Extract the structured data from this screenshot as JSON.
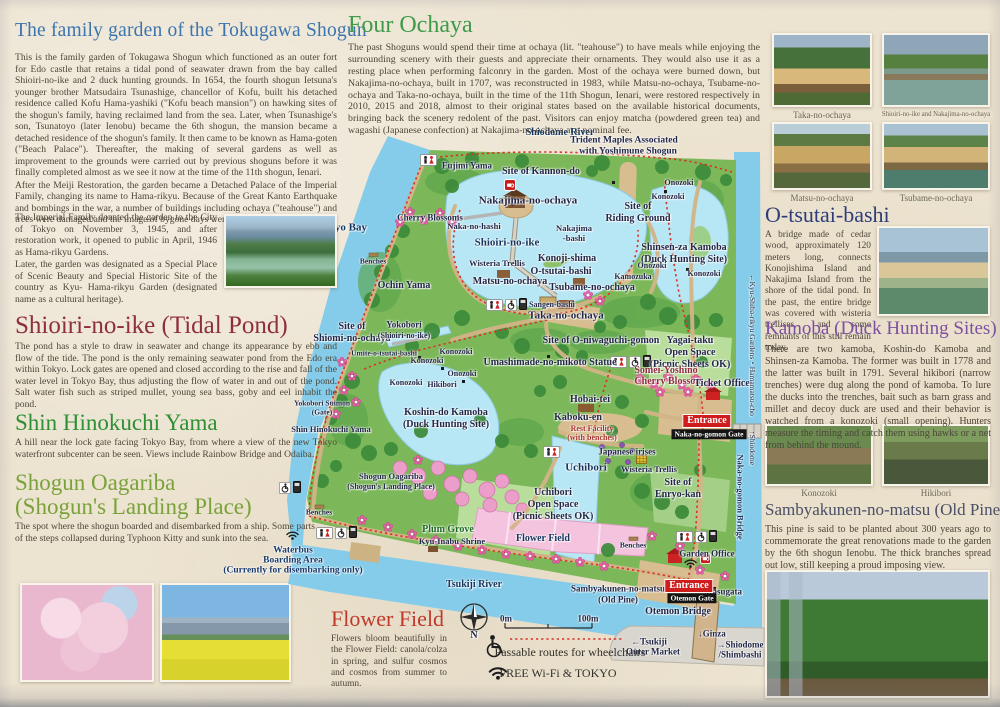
{
  "left": {
    "title": "The family garden of the Tokugawa Shogun",
    "p1": "This is the family garden of Tokugawa Shogun which functioned as an outer fort for Edo castle that retains a tidal pond of seawater drawn from the bay called Shioiri-no-ike and 2 duck hunting grounds. In 1654, the fourth shogun Ietsuna's younger brother Matsudaira Tsunashige, chancellor of Kofu, built his detached residence called Kofu Hama-yashiki (\"Kofu beach mansion\") on hawking sites of the shogun's family, having reclaimed land from the sea. Later, when Tsunashige's son, Tsunatoyo (later Ienobu) became the 6th shogun, the mansion became a detached residence of the shogun's family. It then came to be known as Hama-goten (\"Beach Palace\"). Thereafter, the making of several gardens as well as improvement to the grounds were carried out by previous shoguns before it was finally completed almost as we see it now at the time of the 11th shogun, Ienari.",
    "p2": "After the Meiji Restoration, the garden became a Detached Palace of the Imperial Family, changing its name to Hama-rikyu. Because of the Great Kanto Earthquake and bombings in the war, a number of buildings including ochaya (\"teahouse\") and trees were damaged and the image of bygone days were lost.",
    "p3": "The Imperial Family donated the garden to the City of Tokyo on November 3, 1945, and after restoration work, it opened to public in April, 1946 as Hama-rikyu Gardens.",
    "p4": "Later, the garden was designated as a Special Place of Scenic Beauty and Special Historic Site of the country as Kyu- Hama-rikyu Garden (designated name as a cultural heritage).",
    "shioiri_h": "Shioiri-no-ike (Tidal Pond)",
    "shioiri_p": "The pond has a style to draw in seawater and change its appearance by ebb and flow of the tide. The pond is the only remaining seawater pond from the Edo era within Tokyo. Lock gates are opened and closed according to the rise and fall of the water level in Tokyo Bay, thus adjusting the flow of water in and out of the pond. Salt water fish such as striped mullet, young sea bass, goby and eel inhabit the pond.",
    "shin_h": "Shin Hinokuchi Yama",
    "shin_p": "A hill near the lock gate facing Tokyo Bay, from where a view of the new Tokyo waterfront subcenter can be seen. Views include Rainbow Bridge and Odaiba.",
    "shogun_h1": "Shogun Oagariba",
    "shogun_h2": "(Shogun's Landing Place)",
    "shogun_p": "The spot where the shogun boarded and disembarked from a ship. Some parts of the steps collapsed during Typhoon Kitty and sunk into the sea."
  },
  "center": {
    "ochaya_h": "Four Ochaya",
    "ochaya_p": "The past Shoguns would spend their time at ochaya (lit. \"teahouse\") to have meals while enjoying the surrounding scenery with their guests and appreciate their ornaments. They would also use it as a resting place when performing falconry in the garden. Most of the ochaya were burned down, but Nakajima-no-ochaya, built in 1707, was reconstructed in 1983, while Matsu-no-ochaya, Tsubame-no-ochaya and Taka-no-ochaya, built in the time of the 11th Shogun, Ienari, were restored respectively in 2010, 2015 and 2018, almost to their original states based on the available historical documents, bringing back the scenery redolent of the past. Visitors can enjoy matcha (powdered green tea) and wagashi (Japanese confection) at Nakajima-no-ochaya at a nominal fee.",
    "flower_h": "Flower Field",
    "flower_p": "Flowers bloom beautifully in the Flower Field: canola/colza in spring, and sulfur cosmos and cosmos from summer to autumn."
  },
  "right": {
    "cap_taka": "Taka-no-ochaya",
    "cap_naka": "Shioiri-no-ike and Nakajima-no-ochaya",
    "cap_matsu": "Matsu-no-ochaya",
    "cap_tsubame": "Tsubame-no-ochaya",
    "otsutai_h": "O-tsutai-bashi",
    "otsutai_p": "A bridge made of cedar wood, approximately 120 meters long, connects Konojishima Island and Nakajima Island from the shore of the tidal pond. In the past, the entire bridge was covered with wisteria trellises, and some remnants of this still remain today.",
    "kamoba_h": "Kamoba (Duck Hunting Sites)",
    "kamoba_p": "There are two kamoba, Koshin-do Kamoba and Shinsen-za Kamoba. The former was built in 1778 and the latter was built in 1791. Several hikibori (narrow trenches) were dug along the pond of kamoba. To lure the ducks into the trenches, bait such as barn grass and millet and decoy duck are used and their behavior is watched from a konozoki (small opening). Hunters measure the timing and catch them using hawks or a net from behind the mound.",
    "cap_konozoki": "Konozoki",
    "cap_hikibori": "Hikibori",
    "pine_h": "Sambyakunen-no-matsu (Old Pine)",
    "pine_p": "This pine is said to be planted about 300 years ago to commemorate the great renovations made to the garden by the 6th shogun Ienobu. The thick branches spread out low, still keeping a proud imposing view."
  },
  "map": {
    "accent_colors": {
      "entrance_red": "#cf1d1d",
      "gate_black": "#141414",
      "route_red": "#d93025",
      "sea_blue": "#84cce9",
      "garden_green": "#7cb85a"
    },
    "labels": [
      {
        "t": "Shiodome River",
        "x": 560,
        "y": 133,
        "s": 10,
        "c": "#15355e"
      },
      {
        "t": "Trident Maples Associated",
        "x": 624,
        "y": 141,
        "s": 9.5
      },
      {
        "t": "with Yoshimune Shogun",
        "x": 628,
        "y": 152,
        "s": 9.5
      },
      {
        "t": "Fujimi Yama",
        "x": 467,
        "y": 166,
        "s": 9
      },
      {
        "t": "Site of Kannon-do",
        "x": 541,
        "y": 172,
        "s": 10
      },
      {
        "t": "Onozoki",
        "x": 679,
        "y": 183,
        "s": 8
      },
      {
        "t": "Konozoki",
        "x": 668,
        "y": 197,
        "s": 8
      },
      {
        "t": "Nakajima-no-ochaya",
        "x": 528,
        "y": 201,
        "s": 11
      },
      {
        "t": "Site of",
        "x": 638,
        "y": 207,
        "s": 10
      },
      {
        "t": "Riding Ground",
        "x": 638,
        "y": 219,
        "s": 10
      },
      {
        "t": "Cherry Blossoms",
        "x": 430,
        "y": 218,
        "s": 9
      },
      {
        "t": "Naka-no-hashi",
        "x": 474,
        "y": 226,
        "s": 8.5
      },
      {
        "t": "Nakajima",
        "x": 574,
        "y": 228,
        "s": 8.5
      },
      {
        "t": "-bashi",
        "x": 574,
        "y": 238,
        "s": 8.5
      },
      {
        "t": "Tokyo Bay",
        "x": 342,
        "y": 228,
        "s": 11,
        "c": "#15355e"
      },
      {
        "t": "Shioiri-no-ike",
        "x": 507,
        "y": 243,
        "s": 11,
        "c": "#15355e"
      },
      {
        "t": "Shinsen-za Kamoba",
        "x": 684,
        "y": 248,
        "s": 10
      },
      {
        "t": "(Duck Hunting Site)",
        "x": 684,
        "y": 260,
        "s": 10
      },
      {
        "t": "Benches",
        "x": 373,
        "y": 261,
        "s": 7.5
      },
      {
        "t": "Wisteria Trellis",
        "x": 497,
        "y": 263,
        "s": 8.5
      },
      {
        "t": "Konoji-shima",
        "x": 567,
        "y": 259,
        "s": 10
      },
      {
        "t": "O-tsutai-bashi",
        "x": 561,
        "y": 272,
        "s": 10
      },
      {
        "t": "Onozoki",
        "x": 652,
        "y": 266,
        "s": 8
      },
      {
        "t": "Konozoki",
        "x": 704,
        "y": 274,
        "s": 8
      },
      {
        "t": "Kamozuka",
        "x": 633,
        "y": 277,
        "s": 8
      },
      {
        "t": "Matsu-no-ochaya",
        "x": 510,
        "y": 282,
        "s": 10
      },
      {
        "t": "Ochin Yama",
        "x": 404,
        "y": 286,
        "s": 10
      },
      {
        "t": "Tsubame-no-ochaya",
        "x": 592,
        "y": 288,
        "s": 10
      },
      {
        "t": "Sangen-bashi",
        "x": 552,
        "y": 305,
        "s": 8
      },
      {
        "t": "Taka-no-ochaya",
        "x": 566,
        "y": 316,
        "s": 11
      },
      {
        "t": "Site of",
        "x": 352,
        "y": 327,
        "s": 10
      },
      {
        "t": "Shiomi-no-ochaya",
        "x": 352,
        "y": 339,
        "s": 10
      },
      {
        "t": "Yokobori",
        "x": 404,
        "y": 325,
        "s": 9
      },
      {
        "t": "(Shioiri-no-ike)",
        "x": 404,
        "y": 336,
        "s": 8
      },
      {
        "t": "Umite-o-tsutai-bashi",
        "x": 384,
        "y": 353,
        "s": 7.5
      },
      {
        "t": "Site of O-niwaguchi-gomon",
        "x": 601,
        "y": 341,
        "s": 10
      },
      {
        "t": "Yagai-taku",
        "x": 690,
        "y": 341,
        "s": 10
      },
      {
        "t": "Open Space",
        "x": 690,
        "y": 353,
        "s": 10
      },
      {
        "t": "(Picnic Sheets OK)",
        "x": 690,
        "y": 365,
        "s": 10
      },
      {
        "t": "Umashimade-no-mikoto Statue",
        "x": 550,
        "y": 363,
        "s": 10
      },
      {
        "t": "Konozoki",
        "x": 456,
        "y": 352,
        "s": 8
      },
      {
        "t": "Konozoki",
        "x": 427,
        "y": 361,
        "s": 8
      },
      {
        "t": "Onozoki",
        "x": 462,
        "y": 374,
        "s": 8
      },
      {
        "t": "Konozoki",
        "x": 406,
        "y": 383,
        "s": 8
      },
      {
        "t": "Hikibori",
        "x": 442,
        "y": 385,
        "s": 8
      },
      {
        "t": "Somei-Yoshino",
        "x": 666,
        "y": 371,
        "s": 10,
        "c": "#8e2f3e"
      },
      {
        "t": "Cherry Blossom",
        "x": 669,
        "y": 382,
        "s": 10,
        "c": "#8e2f3e"
      },
      {
        "t": "Ticket Office",
        "x": 722,
        "y": 384,
        "s": 10
      },
      {
        "t": "Yokobori Suimon",
        "x": 322,
        "y": 403,
        "s": 7.5
      },
      {
        "t": "(Gate)",
        "x": 322,
        "y": 412,
        "s": 7.5
      },
      {
        "t": "Koshin-do Kamoba",
        "x": 446,
        "y": 413,
        "s": 10
      },
      {
        "t": "(Duck Hunting Site)",
        "x": 446,
        "y": 425,
        "s": 10
      },
      {
        "t": "Hobai-tei",
        "x": 590,
        "y": 400,
        "s": 10
      },
      {
        "t": "Kaboku-en",
        "x": 578,
        "y": 418,
        "s": 10
      },
      {
        "t": "Rest Facility",
        "x": 592,
        "y": 429,
        "s": 8,
        "c": "#a8332e"
      },
      {
        "t": "(with benches)",
        "x": 592,
        "y": 438,
        "s": 8,
        "c": "#a8332e"
      },
      {
        "t": "Shin Hinokuchi Yama",
        "x": 331,
        "y": 429,
        "s": 8.5
      },
      {
        "t": "Shogun Oagariba",
        "x": 391,
        "y": 476,
        "s": 8.5
      },
      {
        "t": "(Shogun's Landing Place)",
        "x": 391,
        "y": 487,
        "s": 8
      },
      {
        "t": "Japanese irises",
        "x": 627,
        "y": 452,
        "s": 9
      },
      {
        "t": "Uchibori",
        "x": 586,
        "y": 468,
        "s": 11,
        "c": "#15355e"
      },
      {
        "t": "Wisteria Trellis",
        "x": 649,
        "y": 469,
        "s": 8.5
      },
      {
        "t": "Site of",
        "x": 678,
        "y": 483,
        "s": 10
      },
      {
        "t": "Enryo-kan",
        "x": 678,
        "y": 495,
        "s": 10
      },
      {
        "t": "Uchibori",
        "x": 553,
        "y": 493,
        "s": 10
      },
      {
        "t": "Open Space",
        "x": 553,
        "y": 505,
        "s": 10
      },
      {
        "t": "(Picnic Sheets OK)",
        "x": 553,
        "y": 517,
        "s": 10
      },
      {
        "t": "Benches",
        "x": 319,
        "y": 512,
        "s": 7.5
      },
      {
        "t": "Plum Grove",
        "x": 448,
        "y": 530,
        "s": 10,
        "c": "#1f6b24"
      },
      {
        "t": "Kyu-Inabu Shrine",
        "x": 452,
        "y": 541,
        "s": 8.5
      },
      {
        "t": "Flower Field",
        "x": 543,
        "y": 539,
        "s": 10,
        "c": "#15355e"
      },
      {
        "t": "Benches",
        "x": 633,
        "y": 545,
        "s": 7.5
      },
      {
        "t": "Garden Office",
        "x": 707,
        "y": 554,
        "s": 9
      },
      {
        "t": "Waterbus",
        "x": 293,
        "y": 551,
        "s": 9.5,
        "c": "#1a3a6b"
      },
      {
        "t": "Boarding Area",
        "x": 293,
        "y": 561,
        "s": 9.5,
        "c": "#1a3a6b"
      },
      {
        "t": "(Currently for disembarking only)",
        "x": 293,
        "y": 571,
        "s": 9.5,
        "c": "#1a3a6b"
      },
      {
        "t": "Tsukiji River",
        "x": 474,
        "y": 585,
        "s": 10,
        "c": "#15355e"
      },
      {
        "t": "Sambyakunen-no-matsu",
        "x": 618,
        "y": 589,
        "s": 9
      },
      {
        "t": "(Old Pine)",
        "x": 618,
        "y": 600,
        "s": 9
      },
      {
        "t": "Masugata",
        "x": 723,
        "y": 592,
        "s": 9
      },
      {
        "t": "Otemon Bridge",
        "x": 678,
        "y": 612,
        "s": 10
      },
      {
        "t": "↓Ginza",
        "x": 712,
        "y": 634,
        "s": 9
      },
      {
        "t": "←Tsukiji",
        "x": 649,
        "y": 642,
        "s": 9
      },
      {
        "t": "Outer Market",
        "x": 653,
        "y": 652,
        "s": 9
      },
      {
        "t": "→Shiodome",
        "x": 740,
        "y": 645,
        "s": 9
      },
      {
        "t": "/Shimbashi",
        "x": 740,
        "y": 655,
        "s": 9
      },
      {
        "t": "Entrance",
        "x": 707,
        "y": 421,
        "s": 10,
        "k": "box-red"
      },
      {
        "t": "Naka-no-gomon Gate",
        "x": 709,
        "y": 434,
        "s": 7.5,
        "k": "box-black"
      },
      {
        "t": "Entrance",
        "x": 689,
        "y": 586,
        "s": 10,
        "k": "box-red"
      },
      {
        "t": "Otemon Gate",
        "x": 692,
        "y": 598,
        "s": 7.5,
        "k": "box-black"
      },
      {
        "t": "←Kyu-Shiba-rikyu Gardens・Hamamatsu-cho",
        "x": 752,
        "y": 345,
        "s": 7.5,
        "r": 90,
        "w": "400"
      },
      {
        "t": "↑Shiodome",
        "x": 752,
        "y": 448,
        "s": 7.5,
        "r": 90,
        "w": "400"
      },
      {
        "t": "Naka-no-gomon Bridge",
        "x": 740,
        "y": 497,
        "s": 8.5,
        "r": 90,
        "c": "#15355e"
      },
      {
        "t": "N",
        "x": 474,
        "y": 636,
        "s": 10
      },
      {
        "t": "0m",
        "x": 506,
        "y": 619,
        "s": 9
      },
      {
        "t": "100m",
        "x": 588,
        "y": 619,
        "s": 9
      },
      {
        "t": "Passable routes for wheelchairs",
        "x": 570,
        "y": 652,
        "s": 12,
        "w": "400",
        "c": "#33312c",
        "halo": false
      },
      {
        "t": "FREE Wi-Fi & TOKYO",
        "x": 558,
        "y": 673,
        "s": 12,
        "w": "400",
        "c": "#33312c",
        "halo": false
      }
    ]
  }
}
